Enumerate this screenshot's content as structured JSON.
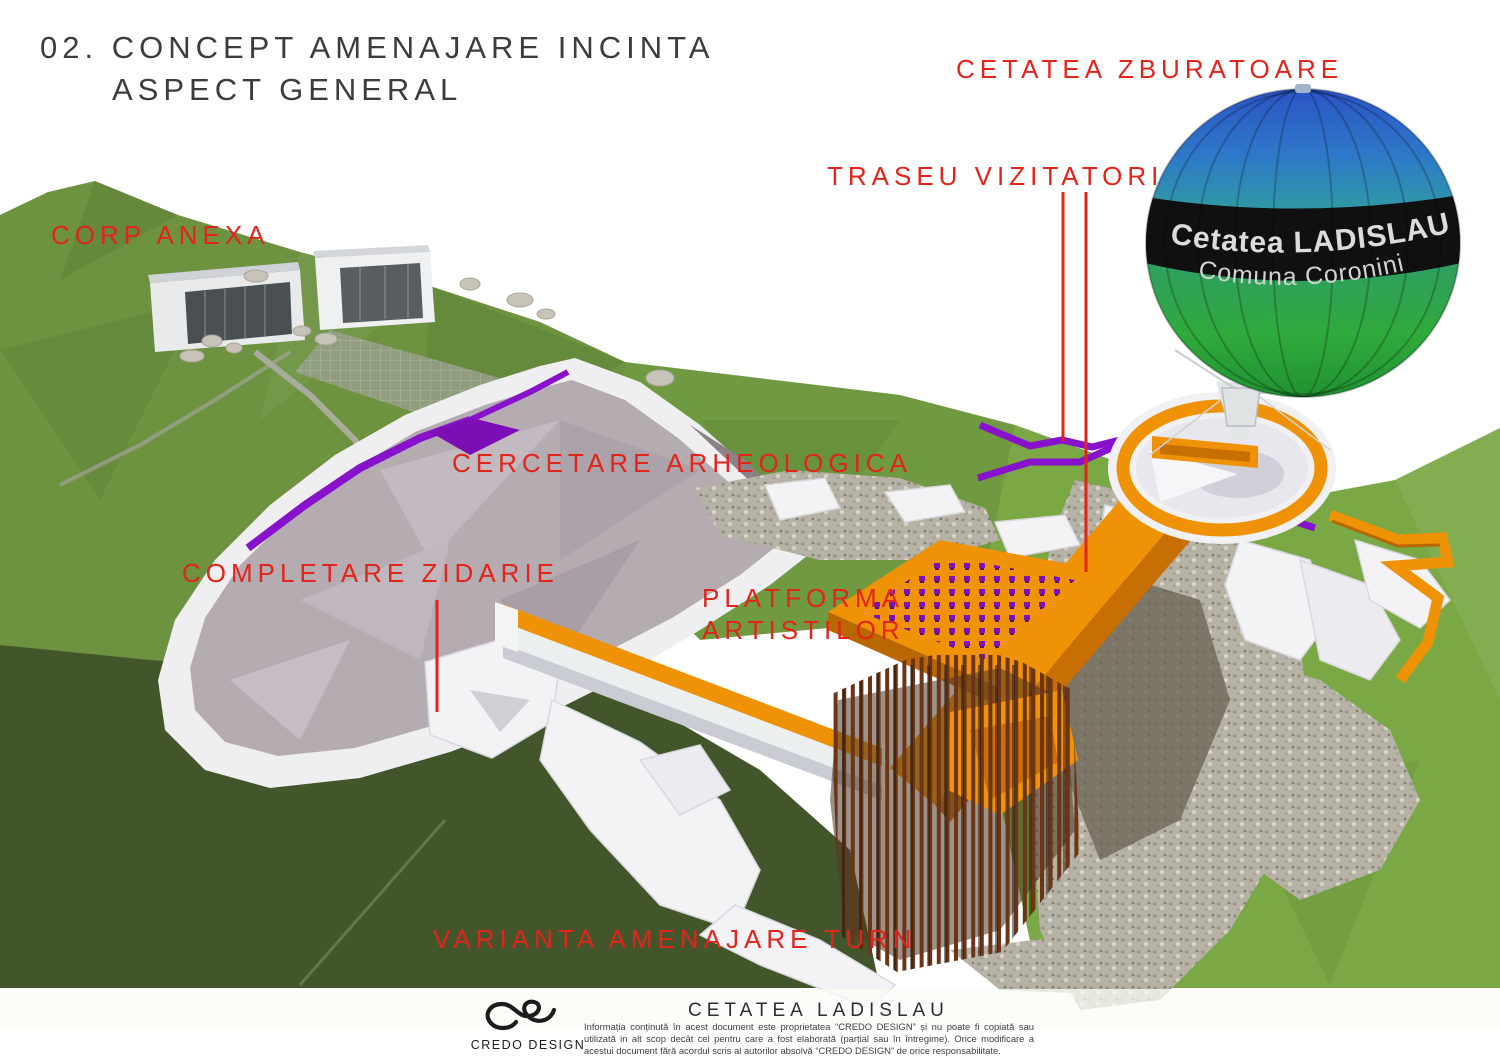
{
  "title": {
    "line1": "02. CONCEPT AMENAJARE INCINTA",
    "line2": "ASPECT GENERAL"
  },
  "labels": {
    "cetatea_zburatoare": "CETATEA ZBURATOARE",
    "traseu_vizitatori": "TRASEU VIZITATORI",
    "corp_anexa": "CORP ANEXA",
    "cercetare_arheologica": "CERCETARE ARHEOLOGICA",
    "completare_zidarie": "COMPLETARE ZIDARIE",
    "platforma_line1": "PLATFORMA",
    "platforma_line2": "ARTISTILOR",
    "varianta_amenajare_turn": "VARIANTA AMENAJARE TURN"
  },
  "balloon": {
    "line1": "Cetatea LADISLAU",
    "line2": "Comuna Coronini"
  },
  "footer": {
    "brand": "CREDO  DESIGN",
    "project_title": "CETATEA   LADISLAU",
    "disclaimer": "Informația conținută în acest document este proprietatea “CREDO DESIGN” și nu poate fi copiată sau utilizată in alt scop decât cel pentru care a fost elaborată (parțial sau în întregime). Orice modificare a acestui document fără acordul scris al autorilor absolvă “CREDO DESIGN” de orice responsabilitate."
  },
  "colors": {
    "annotation_red": "#E2241B",
    "title_gray": "#3C3C3C",
    "walkway_orange": "#EF9206",
    "visitor_path_purple": "#8812CB",
    "excavation_gray": "#B4ACB1",
    "hill_green": "#6D9340",
    "dark_hill_green": "#43552B",
    "corten_rust": "#6E3418",
    "balloon_blue": "#2B52C4",
    "balloon_teal": "#2F9F9E",
    "balloon_green": "#2FAA3C",
    "balloon_band_black": "#101010"
  }
}
